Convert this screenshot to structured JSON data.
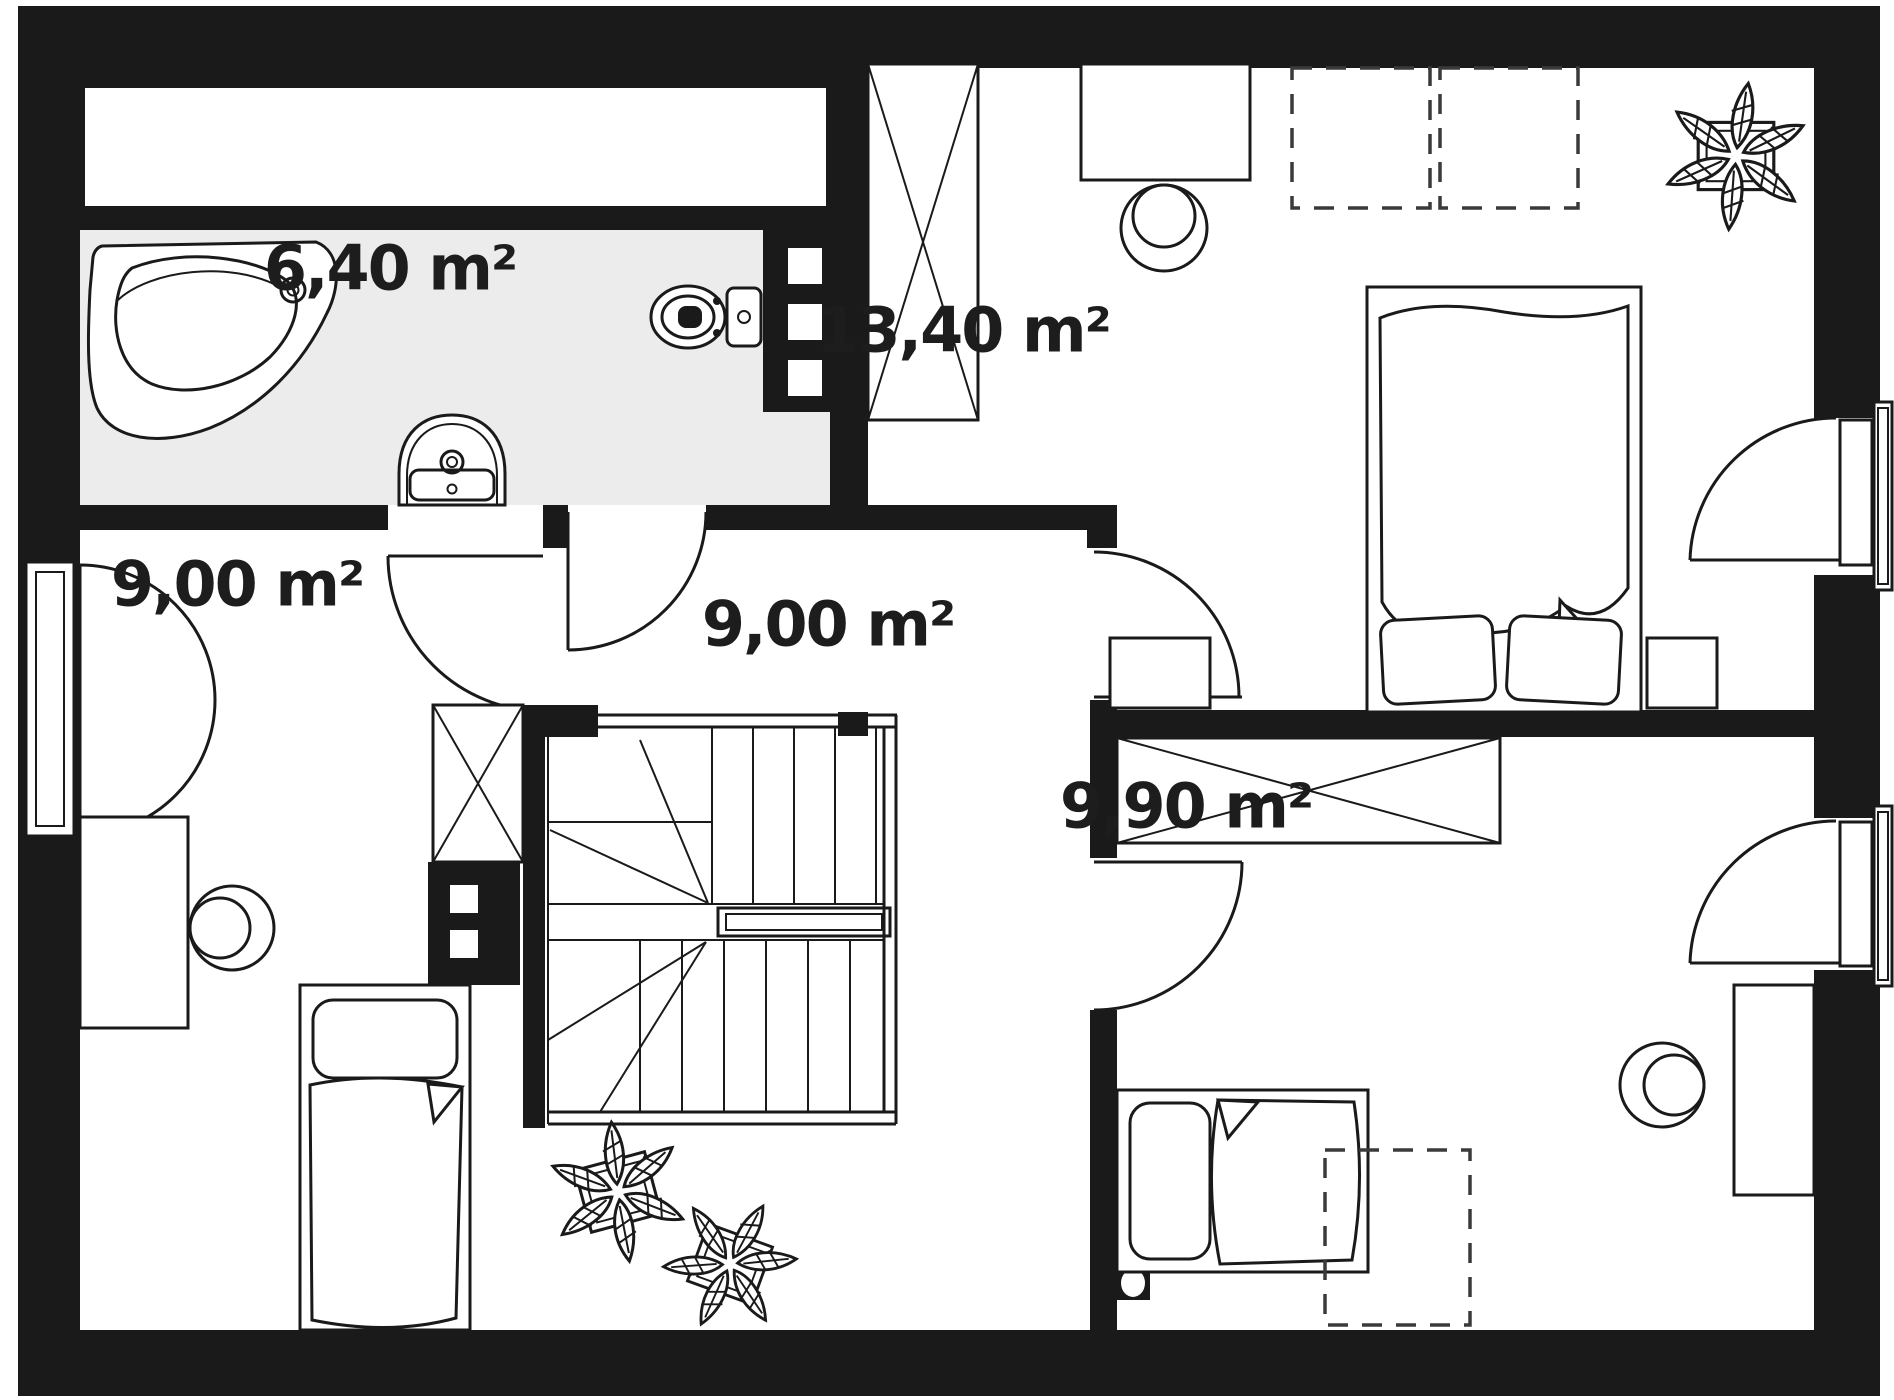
{
  "title": "Attic storey floor plan",
  "colors": {
    "wall": "#1a1a1a",
    "line": "#1a1a1a",
    "bathroom_floor": "#ececec",
    "background": "#ffffff",
    "label_text": "#1d1d1d"
  },
  "rooms": [
    {
      "id": "bathroom",
      "area_label": "6,40 m²"
    },
    {
      "id": "bedroom-top",
      "area_label": "13,40 m²"
    },
    {
      "id": "hallway",
      "area_label": "9,00 m²"
    },
    {
      "id": "bedroom-left",
      "area_label": "9,00 m²"
    },
    {
      "id": "bedroom-bottom",
      "area_label": "9,90 m²"
    }
  ],
  "elements": [
    "bathtub",
    "sink",
    "toilet",
    "installation-shaft",
    "staircase",
    "chimney",
    "wardrobe",
    "double-bed",
    "single-bed",
    "nightstand",
    "desk",
    "chair",
    "window",
    "door",
    "skylight-dashed",
    "plant",
    "radiator"
  ]
}
